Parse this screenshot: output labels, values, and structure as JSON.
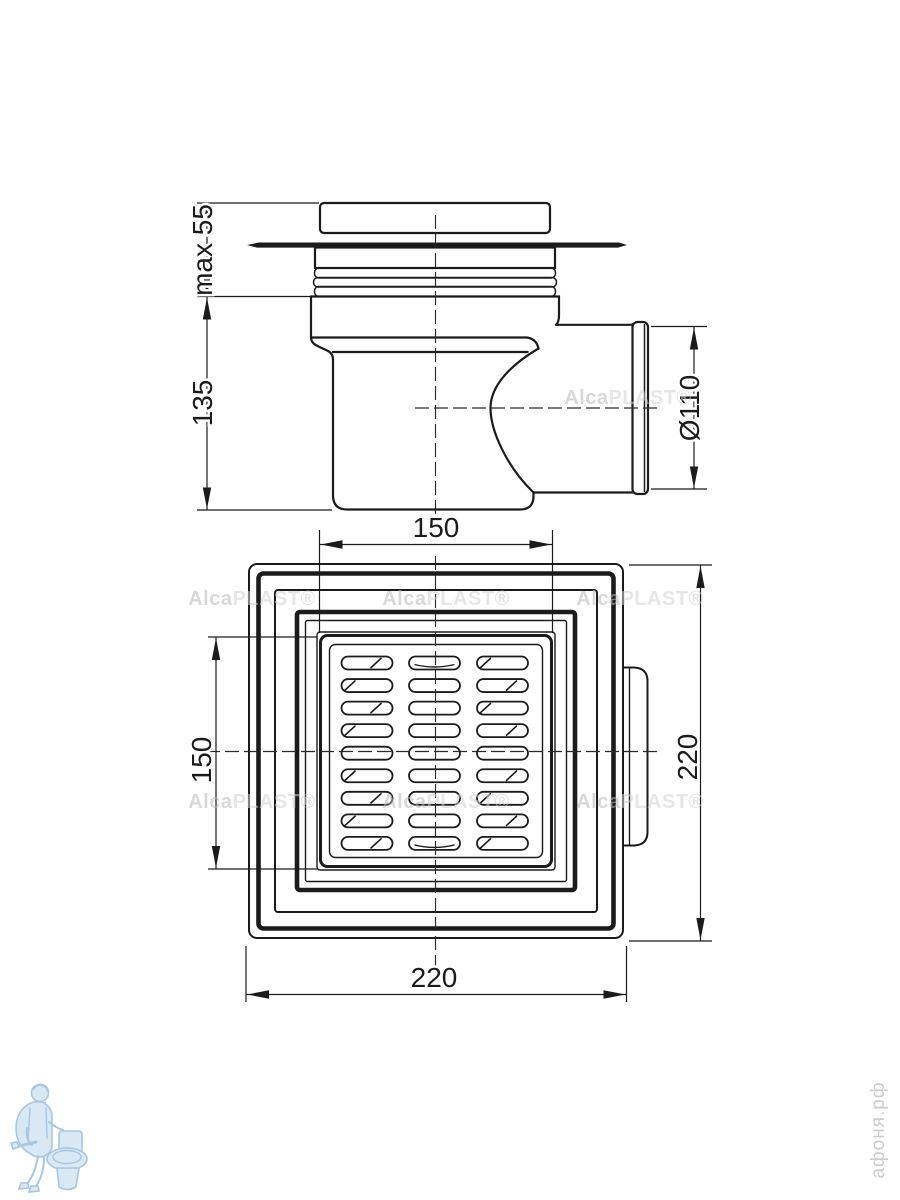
{
  "drawing": {
    "product": "floor-drain-technical-drawing",
    "colors": {
      "line": "#1b1b1b",
      "watermark_gray": "#c6c6c6",
      "site_gray": "#cdcdcd",
      "logo_blue": "#a9c6e1"
    },
    "side_view": {
      "dim_installation_height": "max 55",
      "dim_body_height": "135",
      "dim_outlet_diameter": "Ø110"
    },
    "plan_view": {
      "dim_grate_width": "150",
      "dim_grate_height": "150",
      "dim_body_width": "220",
      "dim_body_height": "220",
      "grate": {
        "rows": 9,
        "cols": 3
      }
    },
    "watermark": {
      "bold_part": "Alca",
      "light_part": "PLAST®"
    },
    "site_watermark": "афоня.рф"
  }
}
